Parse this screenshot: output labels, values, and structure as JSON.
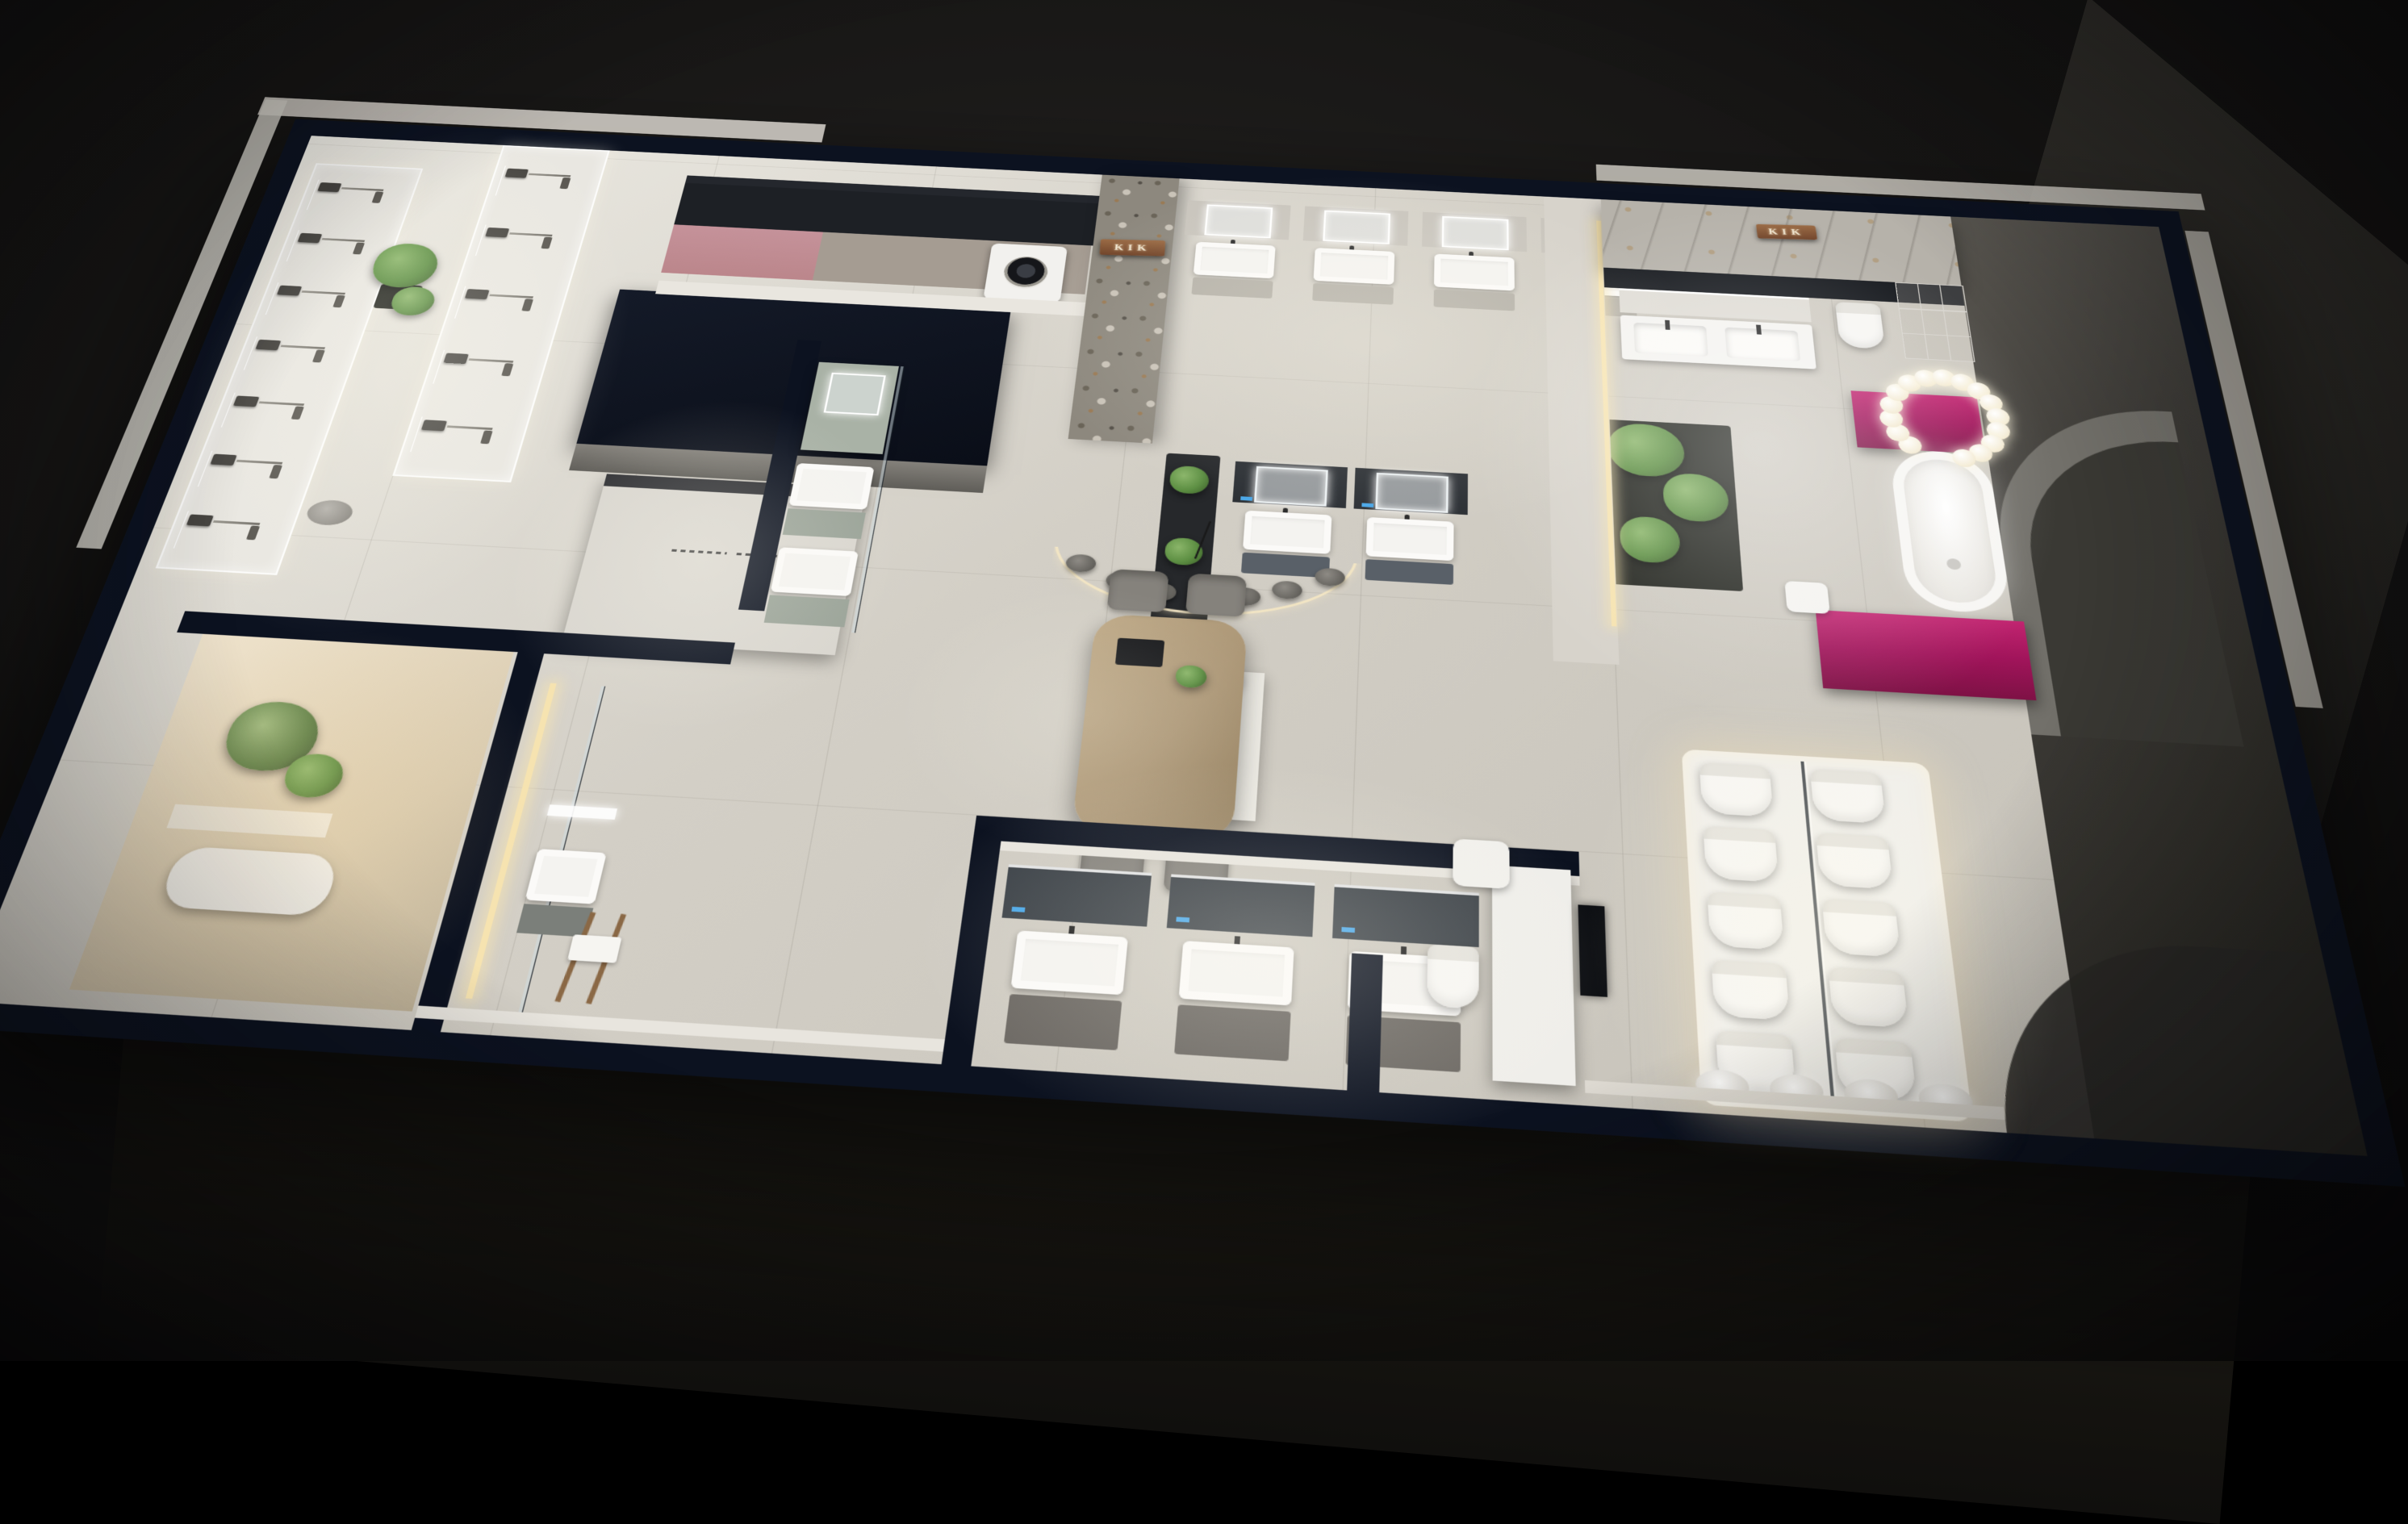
{
  "scene": {
    "brand_signs": [
      {
        "text": "KIK",
        "location": "stone-feature-wall"
      },
      {
        "text": "KIK",
        "location": "suite-marble-wall"
      }
    ],
    "palette": {
      "wallcap": "#0c1220",
      "navy": "#121a2a",
      "floor": "#d3cfc6",
      "bright": "#edebe4",
      "stone": "#8d887e",
      "marble": "#b6b2aa",
      "magenta": "#a0145a",
      "pink": "#bb868b",
      "sage": "#a9b2a6",
      "copper": "#8a5637",
      "wood": "#ad9878",
      "plant": "#5d8f43",
      "led": "#f6e3b0",
      "chair": "#85827c",
      "wing": "#3d3b37",
      "whitefix": "#f4f3f0"
    },
    "counts": {
      "shower_units_left_panel": 7,
      "shower_units_top_panel": 5,
      "wall_vanities": 4,
      "island_vanities": 2,
      "lower_vanities": 3,
      "display_toilet_rows": 5,
      "display_toilet_cols": 2,
      "urinals": 4,
      "chandelier_bubbles": 16,
      "pendant_discs": 7
    }
  }
}
